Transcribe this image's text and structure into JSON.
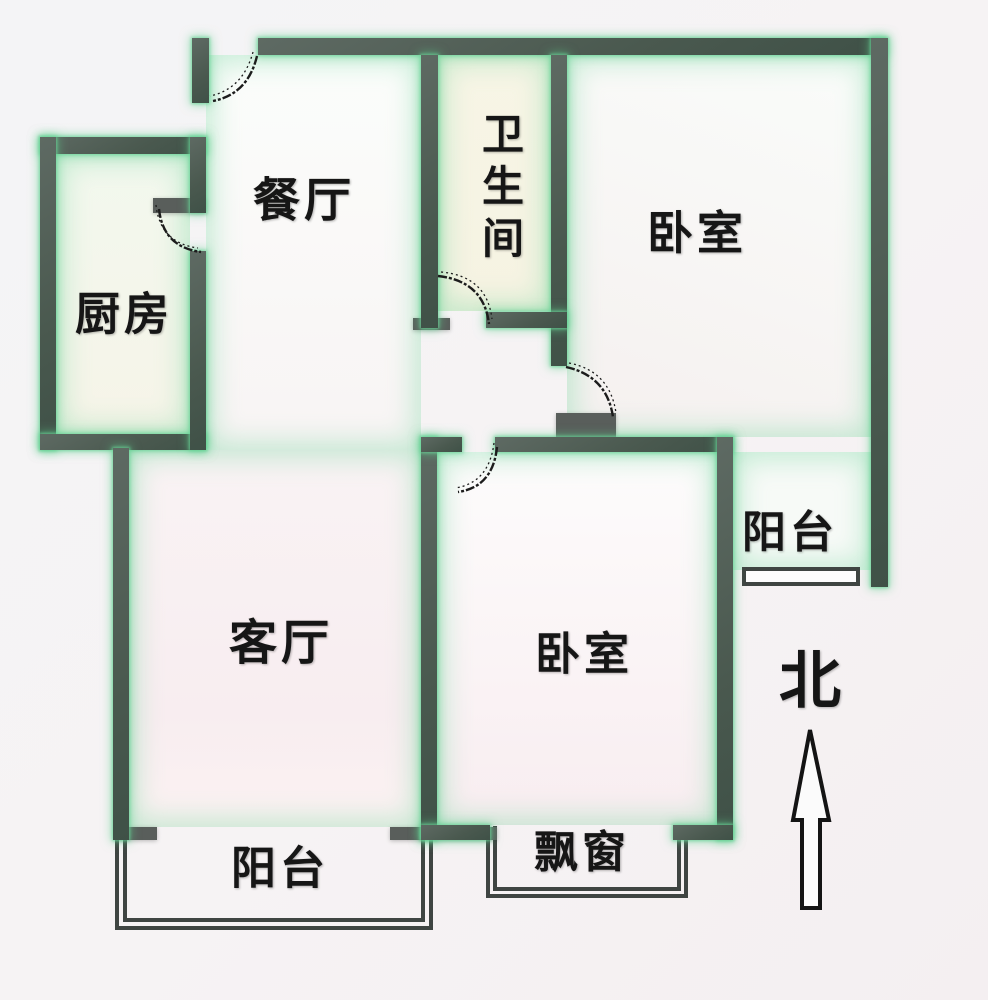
{
  "title": "apartment-floor-plan",
  "rooms": {
    "dining": {
      "label": "餐厅"
    },
    "kitchen": {
      "label": "厨房"
    },
    "bathroom": {
      "label": "卫生间"
    },
    "bedroom_north": {
      "label": "卧室"
    },
    "balcony_east": {
      "label": "阳台"
    },
    "living": {
      "label": "客厅"
    },
    "bedroom_south": {
      "label": "卧室"
    },
    "bay_window": {
      "label": "飘窗"
    },
    "balcony_south": {
      "label": "阳台"
    }
  },
  "compass": {
    "north_label": "北"
  },
  "colors": {
    "background": "#f4f3f5",
    "wall_dark": "#4a594f",
    "wall_gray": "#595e5b",
    "wall_glow_green": "#60cd8f",
    "window_line": "#3f4542",
    "label_text": "#161616",
    "room_pink_tint": "#f8edf0",
    "room_cream_tint": "#f6f3e2",
    "room_green_tint": "#eef8f1"
  }
}
